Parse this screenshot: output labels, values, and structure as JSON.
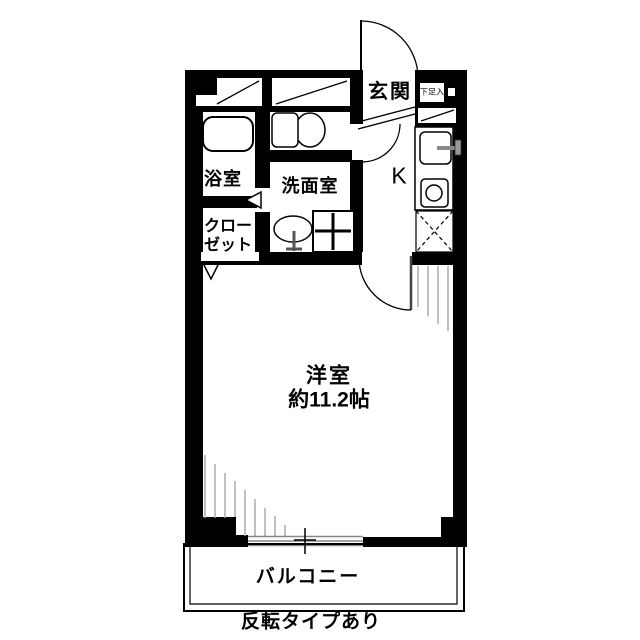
{
  "floor_plan": {
    "rooms": {
      "entrance": {
        "label": "玄関"
      },
      "shoe_storage": {
        "label": "下足入"
      },
      "kitchen": {
        "label": "K"
      },
      "bathroom": {
        "label": "浴室"
      },
      "washroom": {
        "label": "洗面室"
      },
      "closet": {
        "label_line1": "クロー",
        "label_line2": "ゼット"
      },
      "western_room": {
        "label": "洋室",
        "size": "約11.2帖"
      },
      "balcony": {
        "label": "バルコニー"
      }
    },
    "note": "反転タイプあり",
    "colors": {
      "wall": "#000000",
      "background": "#ffffff",
      "hatch": "#aaaaaa",
      "window_line": "#888888"
    }
  }
}
